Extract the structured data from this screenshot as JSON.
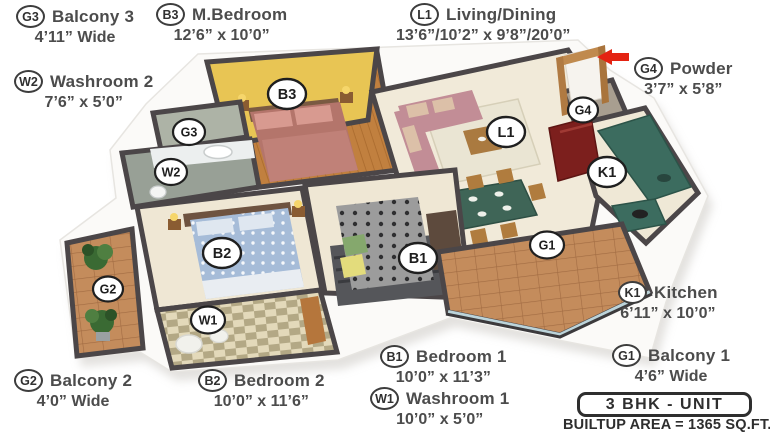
{
  "legend": [
    {
      "id": "g3",
      "code": "G3",
      "name": "Balcony 3",
      "dims": "4’11” Wide"
    },
    {
      "id": "b3",
      "code": "B3",
      "name": "M.Bedroom",
      "dims": "12’6” x 10’0”"
    },
    {
      "id": "l1",
      "code": "L1",
      "name": "Living/Dining",
      "dims": "13’6”/10’2” x 9’8”/20’0”"
    },
    {
      "id": "w2",
      "code": "W2",
      "name": "Washroom 2",
      "dims": "7’6” x 5’0”"
    },
    {
      "id": "g4",
      "code": "G4",
      "name": "Powder",
      "dims": "3’7” x 5’8”"
    },
    {
      "id": "k1",
      "code": "K1",
      "name": "Kitchen",
      "dims": "6’11” x 10’0”"
    },
    {
      "id": "g1",
      "code": "G1",
      "name": "Balcony 1",
      "dims": "4’6” Wide"
    },
    {
      "id": "g2",
      "code": "G2",
      "name": "Balcony 2",
      "dims": "4’0” Wide"
    },
    {
      "id": "b2",
      "code": "B2",
      "name": "Bedroom 2",
      "dims": "10’0” x 11’6”"
    },
    {
      "id": "b1",
      "code": "B1",
      "name": "Bedroom 1",
      "dims": "10’0” x 11’3”"
    },
    {
      "id": "w1",
      "code": "W1",
      "name": "Washroom 1",
      "dims": "10’0” x 5’0”"
    }
  ],
  "markers": {
    "b3": "B3",
    "g3": "G3",
    "w2": "W2",
    "b2": "B2",
    "g2": "G2",
    "w1": "W1",
    "b1": "B1",
    "l1": "L1",
    "g4": "G4",
    "k1": "K1",
    "g1": "G1"
  },
  "unit": {
    "title": "3 BHK - UNIT",
    "area": "BUILTUP AREA = 1365 SQ.FT."
  },
  "colors": {
    "wall": "#4b4648",
    "floor": "#f1ead9",
    "accent_wall_yellow": "#e8c554",
    "master_wood_floor": "#c1803f",
    "bed_master": "#b4756b",
    "bed2_blue": "#a6bcd8",
    "bed1_gray": "#9c9c9c",
    "sofa_pink": "#c28d96",
    "kitchen_counter_green": "#3c6c5f",
    "fridge_red": "#7c1f1d",
    "balcony_tile": "#c48c5c",
    "entry_arrow_red": "#e42312"
  }
}
